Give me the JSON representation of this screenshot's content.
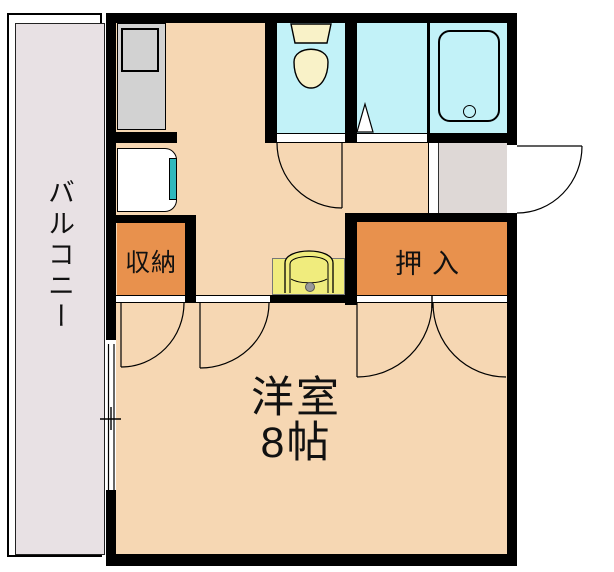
{
  "floorplan": {
    "labels": {
      "balcony": "バルコニー",
      "storage": "収納",
      "oshiire": "押入",
      "room_name": "洋室",
      "room_size": "8帖"
    },
    "colors": {
      "room_floor": "#f6d7b3",
      "closet": "#e8914d",
      "wet_area": "#c2f2f8",
      "balcony": "#e8e1e4",
      "entrance": "#ded8d6",
      "counter": "#d2d2d2",
      "vanity": "#f0ec7d",
      "toilet_fixture": "#f9f2c8",
      "washer_accent": "#2fb8bc",
      "wall": "#000000"
    }
  }
}
